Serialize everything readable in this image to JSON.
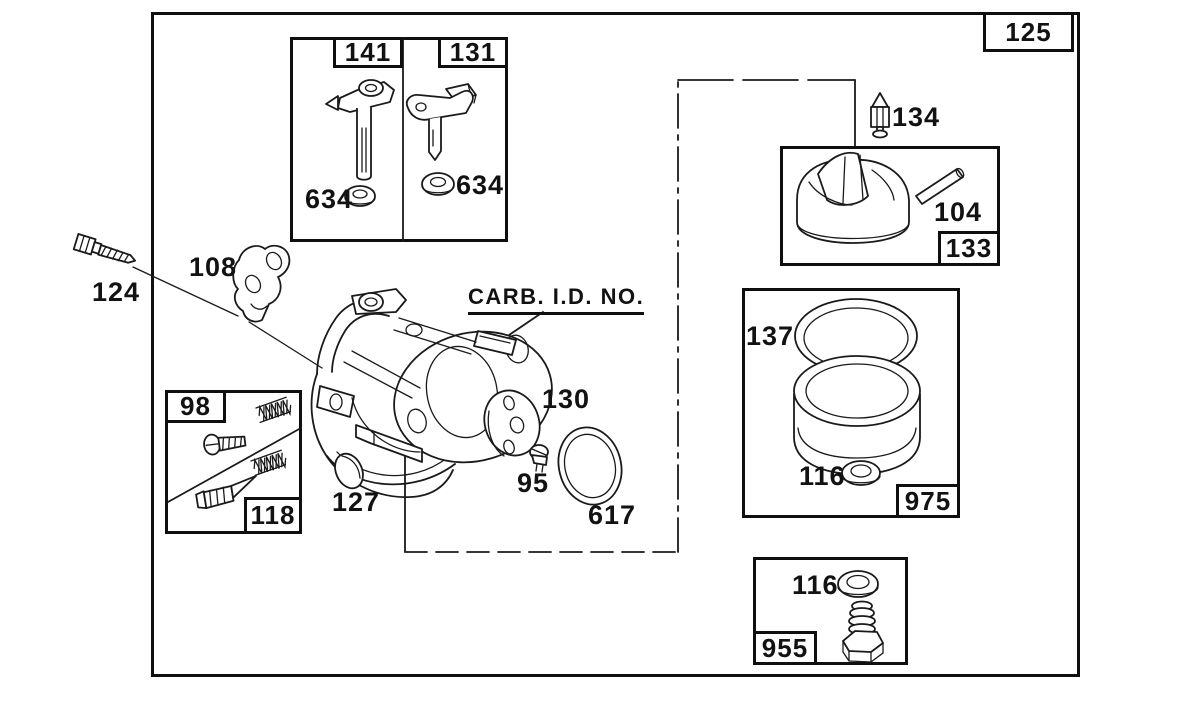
{
  "colors": {
    "background": "#ffffff",
    "ink": "#1a1a1a"
  },
  "page": {
    "assembly_ref": "125"
  },
  "groups": {
    "throttle_box": {
      "label": "141",
      "washer": "634"
    },
    "choke_box": {
      "label": "131",
      "washer": "634"
    },
    "float_box": {
      "label": "133",
      "float": "104"
    },
    "mixture_box": {
      "upper_label": "98",
      "lower_label": "118"
    },
    "bowl_box": {
      "label": "975",
      "gasket": "137",
      "washer": "116"
    },
    "bowl_nut_box": {
      "label": "955",
      "washer": "116"
    }
  },
  "parts": {
    "needle_valve": "134",
    "control_bracket": "108",
    "mounting_screw": "124",
    "carb_id_note": "CARB. I.D. NO.",
    "welch_plug": "127",
    "throttle_plate": "130",
    "plate_screw": "95",
    "o_ring": "617"
  }
}
